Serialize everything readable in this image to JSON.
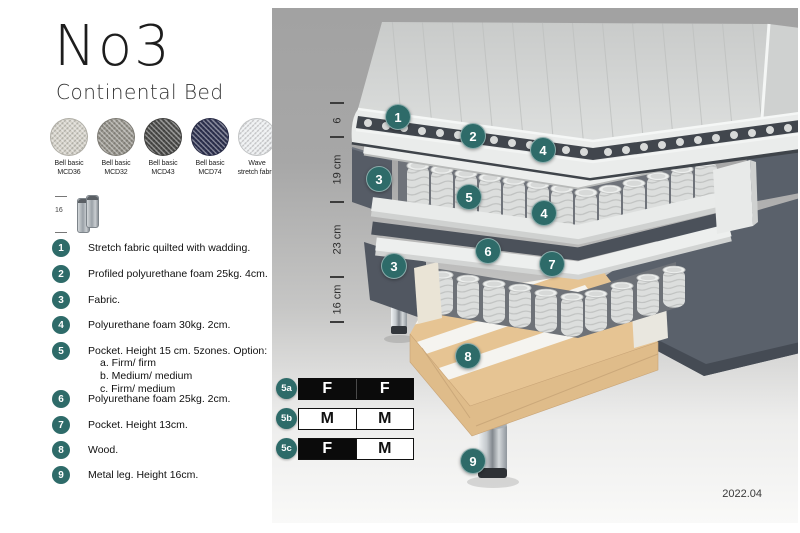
{
  "header": {
    "title": "No3",
    "subtitle": "Continental Bed"
  },
  "swatches": {
    "items": [
      {
        "line1": "Bell basic",
        "line2": "MCD36",
        "color": "#d6d3ca"
      },
      {
        "line1": "Bell basic",
        "line2": "MCD32",
        "color": "#97948c"
      },
      {
        "line1": "Bell basic",
        "line2": "MCD43",
        "color": "#4d4d4b"
      },
      {
        "line1": "Bell basic",
        "line2": "MCD74",
        "color": "#2f3352"
      },
      {
        "line1": "Wave",
        "line2": "stretch fabric",
        "color": "#eceef0"
      }
    ]
  },
  "leg_thumbnail": {
    "height_label": "16"
  },
  "legend": {
    "items": [
      {
        "num": "1",
        "text": "Stretch fabric quilted with wadding."
      },
      {
        "num": "2",
        "text": "Profiled polyurethane foam 25kg. 4cm."
      },
      {
        "num": "3",
        "text": "Fabric."
      },
      {
        "num": "4",
        "text": "Polyurethane foam 30kg. 2cm."
      },
      {
        "num": "5",
        "text": "Pocket. Height 15 cm. 5zones. Option:",
        "options": [
          "a. Firm/ firm",
          "b. Medium/ medium",
          "c. Firm/ medium"
        ]
      },
      {
        "num": "6",
        "text": "Polyurethane foam 25kg. 2cm."
      },
      {
        "num": "7",
        "text": "Pocket. Height 13cm."
      },
      {
        "num": "8",
        "text": "Wood."
      },
      {
        "num": "9",
        "text": "Metal leg. Height 16cm."
      }
    ]
  },
  "diagram": {
    "dimension_labels": [
      "6",
      "19 cm",
      "23 cm",
      "16 cm"
    ],
    "callouts": [
      "1",
      "2",
      "4",
      "3",
      "5",
      "4",
      "6",
      "3",
      "7",
      "8",
      "9"
    ],
    "version": "2022.04"
  },
  "firmness": {
    "rows": [
      {
        "id": "5a",
        "cells": [
          {
            "letter": "F",
            "filled": true
          },
          {
            "letter": "F",
            "filled": true
          }
        ]
      },
      {
        "id": "5b",
        "cells": [
          {
            "letter": "M",
            "filled": false
          },
          {
            "letter": "M",
            "filled": false
          }
        ]
      },
      {
        "id": "5c",
        "cells": [
          {
            "letter": "F",
            "filled": true
          },
          {
            "letter": "M",
            "filled": false
          }
        ]
      }
    ]
  },
  "colors": {
    "accent_teal": "#2e6b69",
    "panel_top": "#a2a2a2",
    "panel_bottom": "#f9f9f8",
    "dark_fabric": "#5a616b",
    "spring": "#dcdedd",
    "wood": "#e6c493",
    "chrome": "#c7ccd0",
    "firmness_black": "#0b0b0b",
    "firmness_white": "#ffffff"
  }
}
